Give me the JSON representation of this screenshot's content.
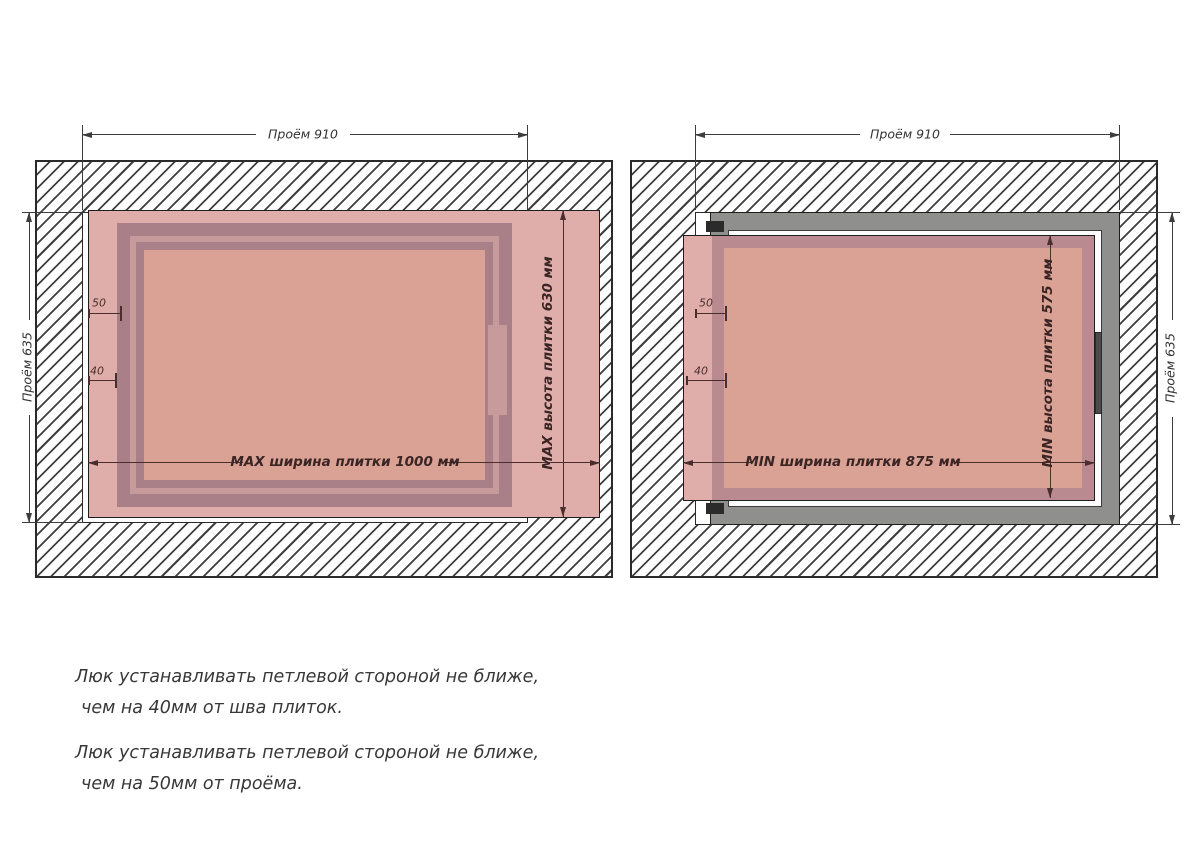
{
  "left_diagram": {
    "opening_width_label": "Проём 910",
    "opening_height_label": "Проём 635",
    "tile_width_label": "MAX ширина плитки 1000 мм",
    "tile_height_label": "MAX высота плитки 630 мм",
    "hinge_to_opening_mm": "50",
    "hinge_to_seam_mm": "40"
  },
  "right_diagram": {
    "opening_width_label": "Проём 910",
    "opening_height_label": "Проём 635",
    "tile_width_label": "MIN ширина плитки 875 мм",
    "tile_height_label": "MIN высота плитки 575 мм",
    "hinge_to_opening_mm": "50",
    "hinge_to_seam_mm": "40"
  },
  "notes": {
    "note1_line1": "Люк устанавливать петлевой стороной не ближе,",
    "note1_line2": "чем на 40мм от шва плиток.",
    "note2_line1": "Люк устанавливать петлевой стороной не ближе,",
    "note2_line2": "чем на 50мм от проёма."
  },
  "colors": {
    "tile_pink": "#dfaeab",
    "door_frame_mauve": "#a98088",
    "frame_inner_light": "#c79a9c",
    "door_panel_salmon": "#d9a295",
    "metal_frame_grey": "#8f8f8d",
    "hatch_line": "#3f3f3f",
    "dimension_dark": "#3d3d3d",
    "dimension_red_brown": "#4a2e2e"
  }
}
